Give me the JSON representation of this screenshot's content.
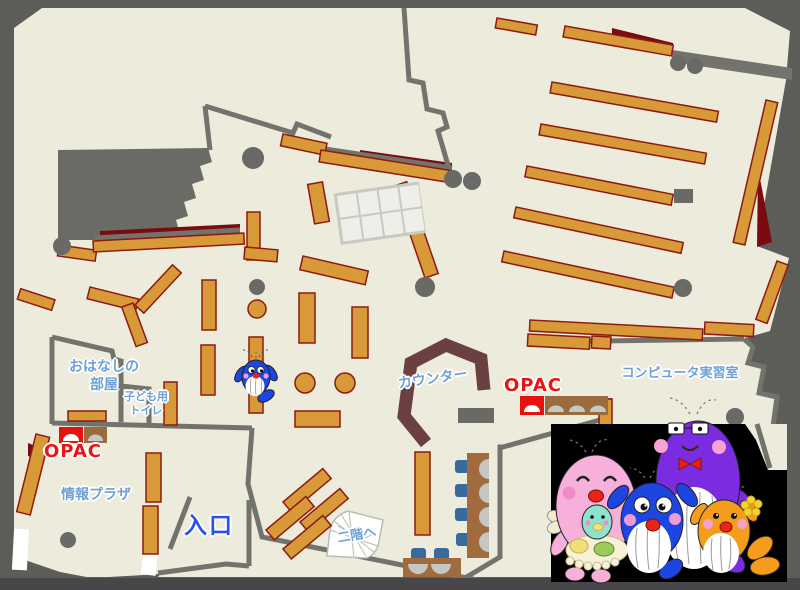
{
  "map": {
    "labels": {
      "story_room": {
        "line1": "おはなしの",
        "line2": "部屋"
      },
      "kids_toilet": {
        "line1": "子ども用",
        "line2": "トイレ"
      },
      "opac_left": "OPAC",
      "opac_right": "OPAC",
      "info_plaza": "情報プラザ",
      "entrance": "入口",
      "stairs": "二階へ",
      "counter": "カウンター",
      "computer_room": "コンピュータ実習室"
    },
    "colors": {
      "outer_background": "#5C5C59",
      "floor": "#EDEBDB",
      "wall": "#73736E",
      "shelf_fill": "#D89939",
      "shelf_border": "#8D1A10",
      "accent_dark_red": "#7A0C10",
      "counter_brown": "#6B4040",
      "desk_brown": "#A06C3E",
      "chair_blue": "#38699F",
      "seat_gray": "#C6C6C2",
      "label_blue": "#6FA0D6",
      "entrance_blue": "#2652F0",
      "opac_red": "#E81515",
      "illustration_background": "#000000",
      "mascot_pink": "#F6B0DA",
      "mascot_purple": "#7B2CE0",
      "mascot_blue": "#1C45E2",
      "mascot_orange": "#F49C1C",
      "mascot_teal": "#8EE2CE"
    },
    "icons": [
      "whale-family-illustration",
      "whale-mascot-icon",
      "stairs-icon",
      "opac-terminal-icon",
      "pillar-icon",
      "study-table-icon",
      "chair-icon",
      "counter-icon"
    ]
  }
}
